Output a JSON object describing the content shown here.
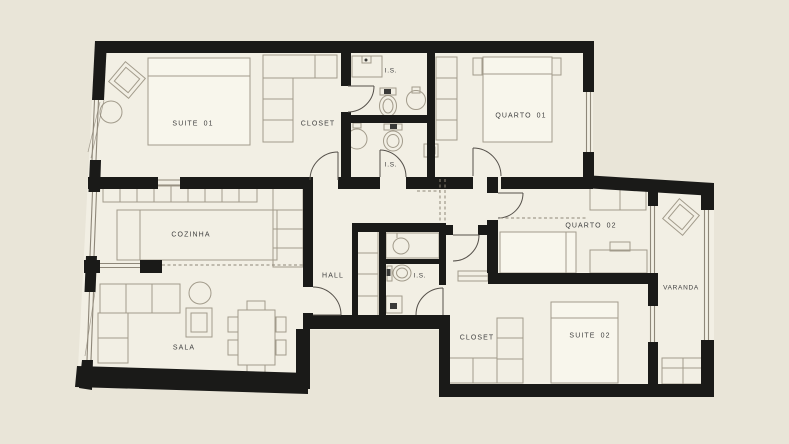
{
  "title": "Apartment floor plan",
  "colors": {
    "background": "#e9e5d8",
    "floor": "#f2efe4",
    "wall": "#1a1a18",
    "furniture": "#a29b8b",
    "label": "#3f3f3f",
    "window": "#8e8779",
    "door": "#55504a"
  },
  "rooms": {
    "suite01": {
      "label": "SUITE 01"
    },
    "closet_top": {
      "label": "CLOSET"
    },
    "is_top": {
      "label": "I.S."
    },
    "quarto01": {
      "label": "QUARTO 01"
    },
    "is_mid": {
      "label": "I.S."
    },
    "cozinha": {
      "label": "COZINHA"
    },
    "hall": {
      "label": "HALL"
    },
    "is_hall": {
      "label": "I.S."
    },
    "quarto02": {
      "label": "QUARTO 02"
    },
    "varanda": {
      "label": "VARANDA"
    },
    "sala": {
      "label": "SALA"
    },
    "closet_bottom": {
      "label": "CLOSET"
    },
    "suite02": {
      "label": "SUITE 02"
    }
  }
}
